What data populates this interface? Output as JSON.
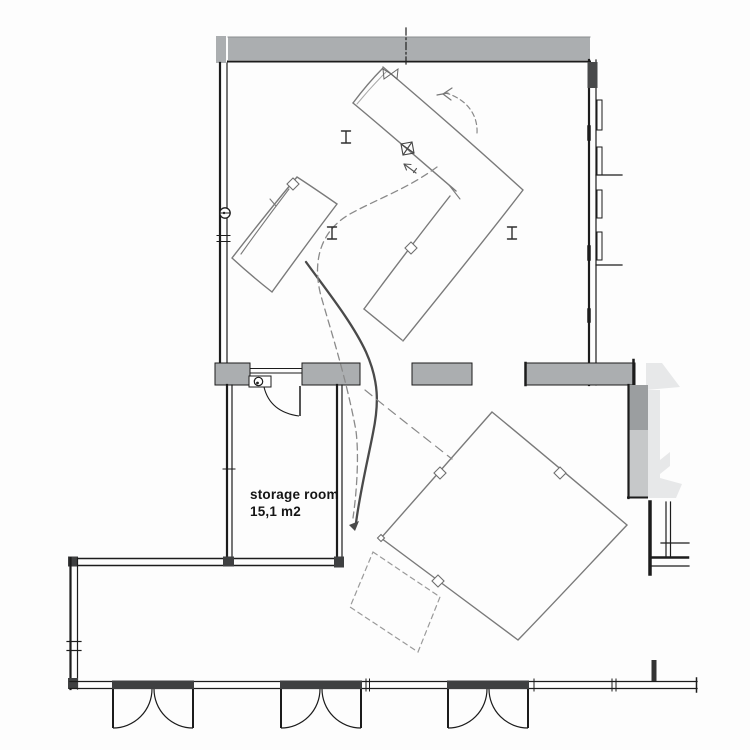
{
  "storage_room": {
    "label": "storage room",
    "area": "15,1 m2"
  },
  "colors": {
    "background": "#fdfdfd",
    "wall_fill": "#abaeb0",
    "wall_fill_dark": "#9b9ea0",
    "stair_fill": "#e7e8e9",
    "stair_fill_light": "#eef0f0",
    "cad_line": "#1c1c1c",
    "joint_dark": "#3f4041",
    "sketch_line": "#7a7a7a",
    "sketch_heavy": "#4a4a4a",
    "sketch_dashed": "#8a8a8a",
    "text": "#151515"
  },
  "icons": {
    "door_swing": "door-swing-icon",
    "double_door": "double-door-swing-icon",
    "entry_stair_arrow": "entry-stair-arrow-icon",
    "movement_arrow": "movement-arrow-icon",
    "rotation_arrow": "rotation-arrow-icon",
    "diamond_marker": "diamond-marker-icon",
    "i_beam_marker": "i-beam-marker-icon",
    "wall_outlet": "wall-outlet-icon",
    "bowtie_valve": "bowtie-marker-icon",
    "crossed_box": "crossed-box-marker-icon"
  }
}
